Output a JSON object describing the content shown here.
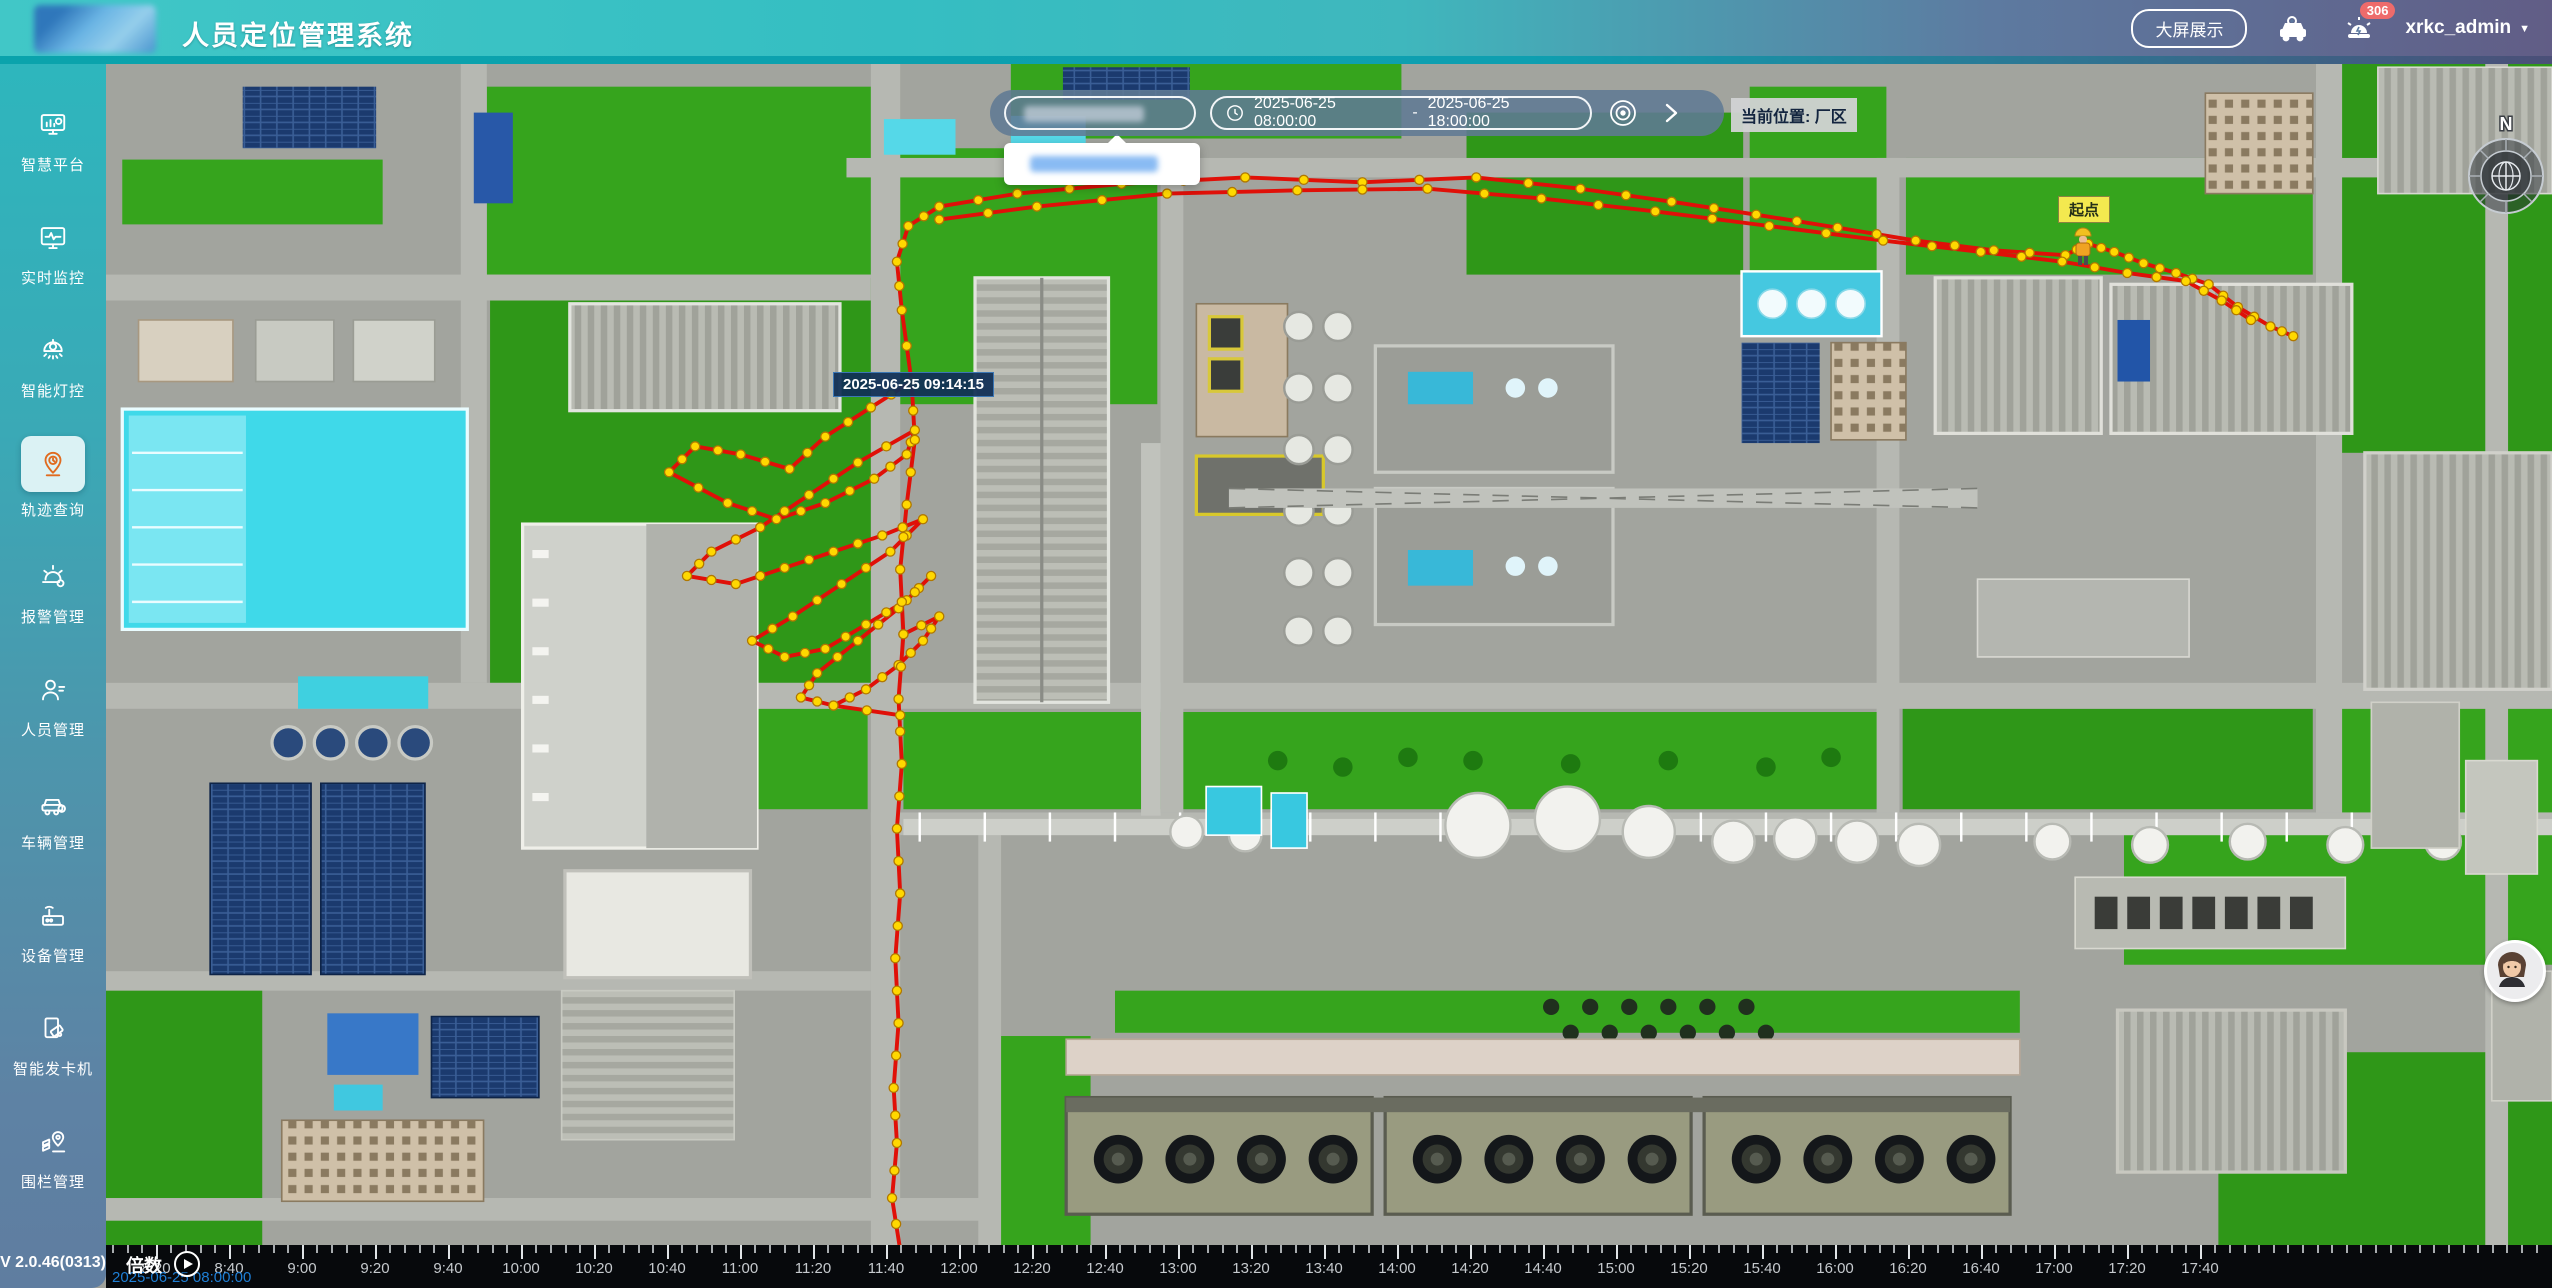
{
  "header": {
    "title": "人员定位管理系统",
    "big_screen_button": "大屏展示",
    "alarm_badge": "306",
    "username": "xrkc_admin",
    "caret": "▼"
  },
  "sidebar": {
    "items": [
      {
        "label": "智慧平台",
        "icon": "platform-icon",
        "active": false
      },
      {
        "label": "实时监控",
        "icon": "monitor-icon",
        "active": false
      },
      {
        "label": "智能灯控",
        "icon": "lamp-icon",
        "active": false
      },
      {
        "label": "轨迹查询",
        "icon": "trajectory-icon",
        "active": true
      },
      {
        "label": "报警管理",
        "icon": "alarm-icon",
        "active": false
      },
      {
        "label": "人员管理",
        "icon": "person-icon",
        "active": false
      },
      {
        "label": "车辆管理",
        "icon": "vehicle-icon",
        "active": false
      },
      {
        "label": "设备管理",
        "icon": "device-icon",
        "active": false
      },
      {
        "label": "智能发卡机",
        "icon": "card-icon",
        "active": false
      },
      {
        "label": "围栏管理",
        "icon": "fence-icon",
        "active": false
      }
    ],
    "version": "V 2.0.46(0313)"
  },
  "toolbar": {
    "date_start": "2025-06-25 08:00:00",
    "date_separator": "-",
    "date_end": "2025-06-25 18:00:00",
    "current_location_label": "当前位置: 厂区"
  },
  "map": {
    "tooltip": "2025-06-25 09:14:15",
    "start_label": "起点",
    "compass_label": "N",
    "colors": {
      "track": "#e01008",
      "dot": "#ffd800",
      "dot_edge": "#b07800"
    },
    "trajectory": {
      "top_line": [
        [
          495,
          196
        ],
        [
          489,
          152
        ],
        [
          486,
          122
        ],
        [
          493,
          100
        ],
        [
          512,
          88
        ],
        [
          560,
          80
        ],
        [
          624,
          74
        ],
        [
          700,
          70
        ],
        [
          772,
          73
        ],
        [
          842,
          70
        ],
        [
          906,
          77
        ],
        [
          962,
          85
        ],
        [
          1014,
          93
        ],
        [
          1064,
          101
        ],
        [
          1112,
          109
        ],
        [
          1160,
          115
        ],
        [
          1204,
          118
        ],
        [
          1218,
          111
        ],
        [
          1234,
          116
        ],
        [
          1252,
          123
        ],
        [
          1272,
          129
        ],
        [
          1292,
          136
        ],
        [
          1310,
          150
        ],
        [
          1330,
          162
        ],
        [
          1344,
          168
        ]
      ],
      "top_line2": [
        [
          512,
          96
        ],
        [
          572,
          88
        ],
        [
          652,
          80
        ],
        [
          732,
          78
        ],
        [
          812,
          77
        ],
        [
          882,
          83
        ],
        [
          952,
          91
        ],
        [
          1022,
          100
        ],
        [
          1092,
          109
        ],
        [
          1152,
          116
        ],
        [
          1202,
          122
        ],
        [
          1242,
          129
        ],
        [
          1278,
          134
        ],
        [
          1300,
          146
        ],
        [
          1318,
          158
        ]
      ],
      "cluster": [
        [
          495,
          196
        ],
        [
          470,
          212
        ],
        [
          442,
          230
        ],
        [
          420,
          250
        ],
        [
          390,
          241
        ],
        [
          362,
          236
        ],
        [
          346,
          252
        ],
        [
          382,
          271
        ],
        [
          412,
          281
        ],
        [
          442,
          271
        ],
        [
          472,
          256
        ],
        [
          492,
          241
        ],
        [
          497,
          226
        ],
        [
          462,
          246
        ],
        [
          432,
          266
        ],
        [
          402,
          286
        ],
        [
          372,
          301
        ],
        [
          357,
          316
        ],
        [
          387,
          321
        ],
        [
          417,
          311
        ],
        [
          447,
          301
        ],
        [
          477,
          291
        ],
        [
          502,
          281
        ],
        [
          482,
          301
        ],
        [
          452,
          321
        ],
        [
          422,
          341
        ],
        [
          397,
          356
        ],
        [
          417,
          366
        ],
        [
          442,
          361
        ],
        [
          467,
          346
        ],
        [
          492,
          331
        ],
        [
          507,
          316
        ],
        [
          487,
          336
        ],
        [
          462,
          356
        ],
        [
          437,
          376
        ],
        [
          427,
          391
        ],
        [
          447,
          396
        ],
        [
          467,
          386
        ],
        [
          487,
          371
        ],
        [
          502,
          356
        ],
        [
          512,
          341
        ],
        [
          490,
          352
        ]
      ],
      "vertical": [
        [
          495,
          196
        ],
        [
          497,
          232
        ],
        [
          492,
          272
        ],
        [
          488,
          312
        ],
        [
          490,
          352
        ],
        [
          487,
          392
        ],
        [
          489,
          432
        ],
        [
          486,
          472
        ],
        [
          488,
          512
        ],
        [
          485,
          552
        ],
        [
          487,
          592
        ],
        [
          484,
          632
        ],
        [
          486,
          666
        ],
        [
          483,
          700
        ],
        [
          488,
          732
        ]
      ],
      "spur": [
        [
          447,
          396
        ],
        [
          488,
          402
        ]
      ]
    }
  },
  "timeline": {
    "speed_label": "倍数",
    "current_time": "2025-06-25 08:00:00",
    "tick_labels": [
      "8:20",
      "8:40",
      "9:00",
      "9:20",
      "9:40",
      "10:00",
      "10:20",
      "10:40",
      "11:00",
      "11:20",
      "11:40",
      "12:00",
      "12:20",
      "12:40",
      "13:00",
      "13:20",
      "13:40",
      "14:00",
      "14:20",
      "14:40",
      "15:00",
      "15:20",
      "15:40",
      "16:00",
      "16:20",
      "16:40",
      "17:00",
      "17:20",
      "17:40"
    ]
  }
}
